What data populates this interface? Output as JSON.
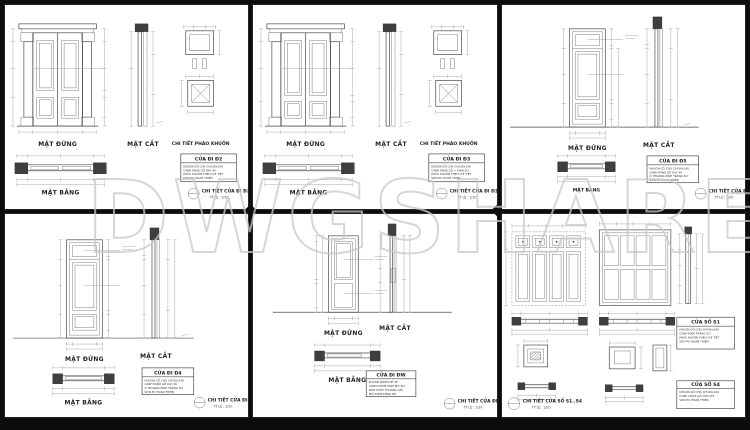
{
  "watermark": {
    "text": "DWGSHARE",
    "suffix": ".com"
  },
  "labels": {
    "elevation": "MẶT ĐỨNG",
    "section": "MẶT CẮT",
    "plan": "MẶT BẰNG",
    "molding_detail": "CHI TIẾT PHÀO KHUÔN",
    "scale": "TỶ LỆ : 1/20"
  },
  "panels": [
    {
      "id": "door-d2",
      "title": "CỬA ĐI Đ2",
      "detail_label": "CHI TIẾT CỬA ĐI Đ2",
      "specs": [
        "KHUÔN GỖ CHÒ CHỈ 60x140",
        "CÁNH PANÔ GỖ DÀY 40",
        "PHÀO KHUÔN THEO CHI TIẾT",
        "SƠN PU HOÀN THIỆN"
      ]
    },
    {
      "id": "door-d3",
      "title": "CỬA ĐI Đ3",
      "detail_label": "CHI TIẾT CỬA ĐI Đ3",
      "specs": [
        "KHUÔN GỖ CHÒ CHỈ 60x140",
        "CÁNH PANÔ GỖ + KÍNH 5LY",
        "PHÀO KHUÔN THEO CHI TIẾT",
        "SƠN PU HOÀN THIỆN"
      ]
    },
    {
      "id": "door-d5",
      "title": "CỬA ĐI Đ5",
      "detail_label": "CHI TIẾT CỬA ĐI Đ5",
      "specs": [
        "KHUÔN GỖ CHÒ CHỈ 60x140",
        "CÁNH PANÔ GỖ DÀY 40",
        "Ô THOÁNG KÍNH TRẮNG 5LY",
        "SƠN PU HOÀN THIỆN"
      ]
    },
    {
      "id": "door-d4",
      "title": "CỬA ĐI Đ4",
      "detail_label": "CHI TIẾT CỬA ĐI Đ4",
      "specs": [
        "KHUÔN GỖ CHÒ CHỈ 60x140",
        "CÁNH PANÔ GỖ DÀY 40",
        "Ô THOÁNG KÍNH TRẮNG 5LY",
        "SƠN PU HOÀN THIỆN"
      ]
    },
    {
      "id": "door-dw",
      "title": "CỬA ĐI ĐW",
      "detail_label": "CHI TIẾT CỬA ĐI ĐW",
      "specs": [
        "KHUÔN NHÔM HỆ 38",
        "CÁNH NHÔM KÍNH MỜ 5LY",
        "NAN CHỚP THOÁNG GIÓ",
        "PHỤ KIỆN ĐỒNG BỘ"
      ]
    },
    {
      "id": "windows-s1-s4",
      "detail_label": "CHI TIẾT CỬA SỔ S1..S4",
      "title_blocks": [
        {
          "title": "CỬA SỔ S1",
          "specs": [
            "KHUÔN GỖ CHÒ CHỈ 60x140",
            "CÁNH KÍNH TRẮNG 5LY",
            "PHÀO KHUÔN THEO CHI TIẾT",
            "SƠN PU HOÀN THIỆN"
          ]
        },
        {
          "title": "CỬA SỔ S4",
          "specs": [
            "KHUÔN GỖ CHÒ CHỈ 60x140",
            "CÁNH CHỚP GỖ CHÒ CHỈ",
            "SƠN PU HOÀN THIỆN"
          ]
        }
      ]
    }
  ]
}
